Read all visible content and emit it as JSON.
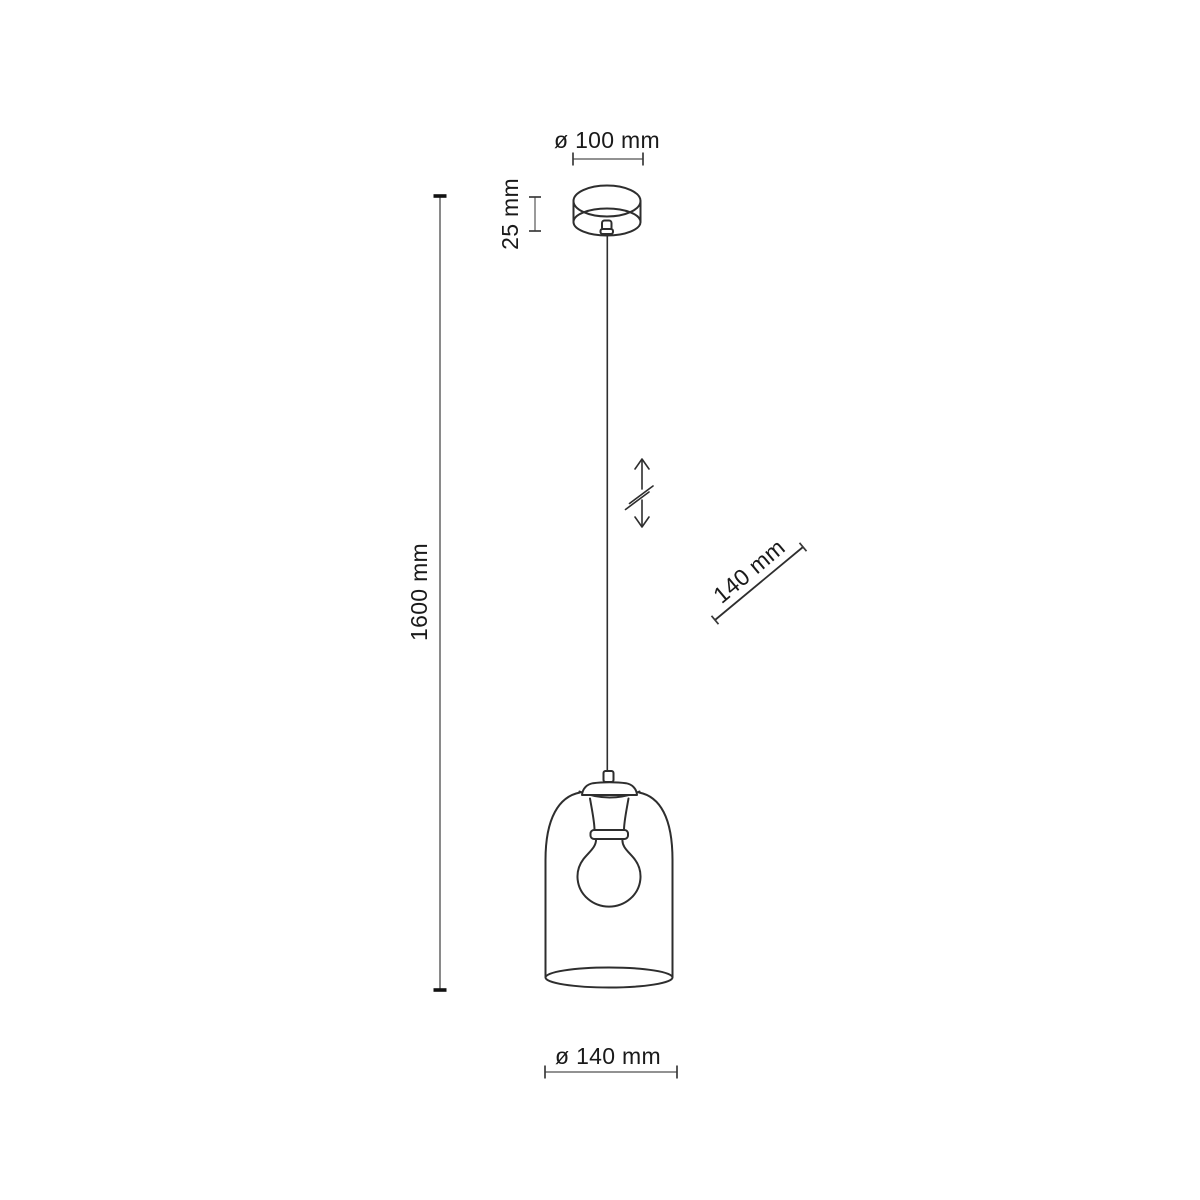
{
  "diagram": {
    "subject": "pendant-lamp-dimension-drawing",
    "background_color": "#ffffff",
    "line_color": "#2e2e2e",
    "dimension_line_color": "#6e6e6e",
    "text_color": "#1a1a1a"
  },
  "labels": {
    "canopy_diameter": "ø 100 mm",
    "canopy_height": "25 mm",
    "overall_length": "1600 mm",
    "shade_height": "140 mm",
    "shade_diameter": "ø 140 mm"
  },
  "icons": {
    "adjustable_height_icon": "vertical double arrow with break slashes (adjustable cable length)"
  }
}
